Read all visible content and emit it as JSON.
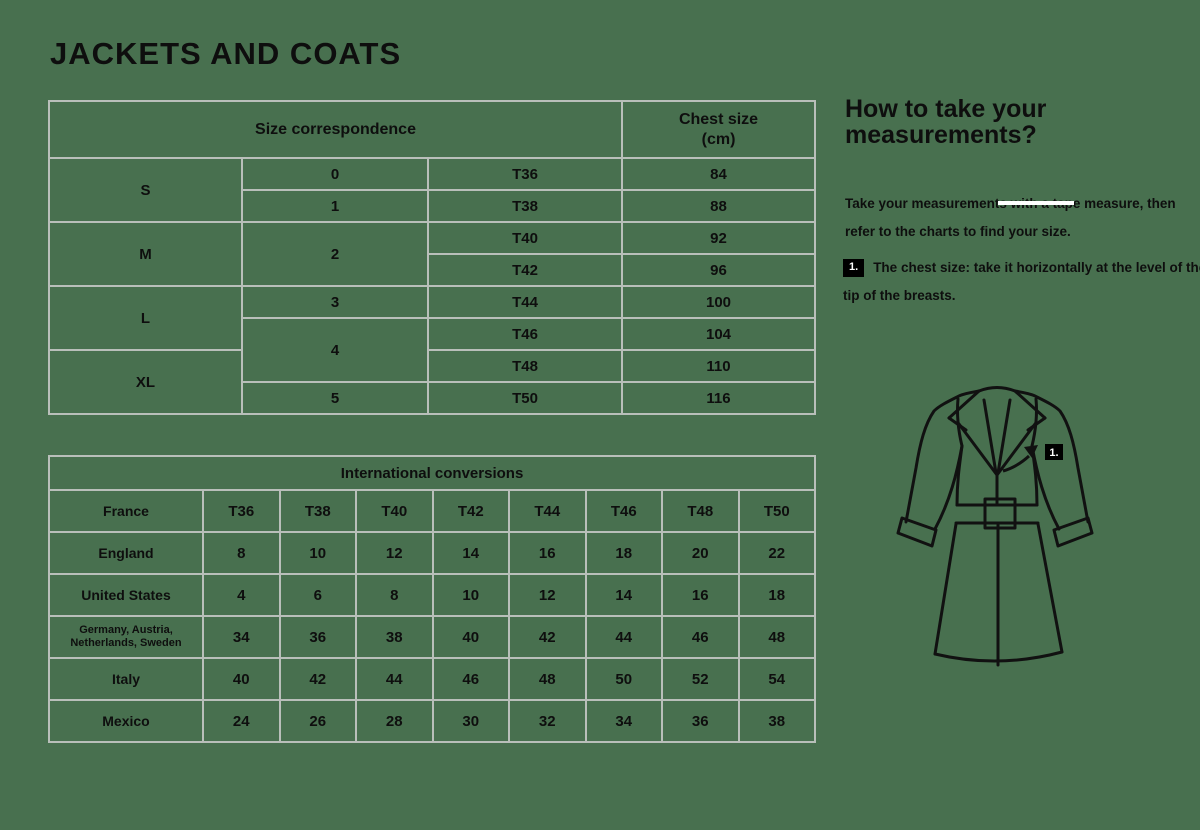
{
  "colors": {
    "background": "#48704f",
    "table_border": "#b9bfba",
    "text": "#0e0e0e",
    "badge_background": "#000000",
    "badge_text": "#ffffff"
  },
  "page": {
    "title": "JACKETS AND COATS"
  },
  "size_table": {
    "title": "Size correspondence",
    "chest_title": "Chest size",
    "chest_unit": "(cm)",
    "sizes": [
      "S",
      "M",
      "L",
      "XL"
    ],
    "numbers": [
      "0",
      "1",
      "2",
      "3",
      "4",
      "5"
    ],
    "rows": [
      {
        "fr": "T36",
        "chest": "84"
      },
      {
        "fr": "T38",
        "chest": "88"
      },
      {
        "fr": "T40",
        "chest": "92"
      },
      {
        "fr": "T42",
        "chest": "96"
      },
      {
        "fr": "T44",
        "chest": "100"
      },
      {
        "fr": "T46",
        "chest": "104"
      },
      {
        "fr": "T48",
        "chest": "110"
      },
      {
        "fr": "T50",
        "chest": "116"
      }
    ]
  },
  "conversion_table": {
    "title": "International conversions",
    "rows": [
      {
        "label": "France",
        "values": [
          "T36",
          "T38",
          "T40",
          "T42",
          "T44",
          "T46",
          "T48",
          "T50"
        ]
      },
      {
        "label": "England",
        "values": [
          "8",
          "10",
          "12",
          "14",
          "16",
          "18",
          "20",
          "22"
        ]
      },
      {
        "label": "United States",
        "values": [
          "4",
          "6",
          "8",
          "10",
          "12",
          "14",
          "16",
          "18"
        ]
      },
      {
        "label": "Germany, Austria, Netherlands, Sweden",
        "values": [
          "34",
          "36",
          "38",
          "40",
          "42",
          "44",
          "46",
          "48"
        ]
      },
      {
        "label": "Italy",
        "values": [
          "40",
          "42",
          "44",
          "46",
          "48",
          "50",
          "52",
          "54"
        ]
      },
      {
        "label": "Mexico",
        "values": [
          "24",
          "26",
          "28",
          "30",
          "32",
          "34",
          "36",
          "38"
        ]
      }
    ]
  },
  "instructions": {
    "heading": "How to take your measurements?",
    "intro": "Take your measurements with a tape measure, then refer to the charts to find your size.",
    "step_number": "1.",
    "step_text": "The chest size: take it horizontally at the level of the tip of the breasts."
  },
  "coat": {
    "badge_label": "1.",
    "icon_name": "trench-coat-line-drawing"
  }
}
